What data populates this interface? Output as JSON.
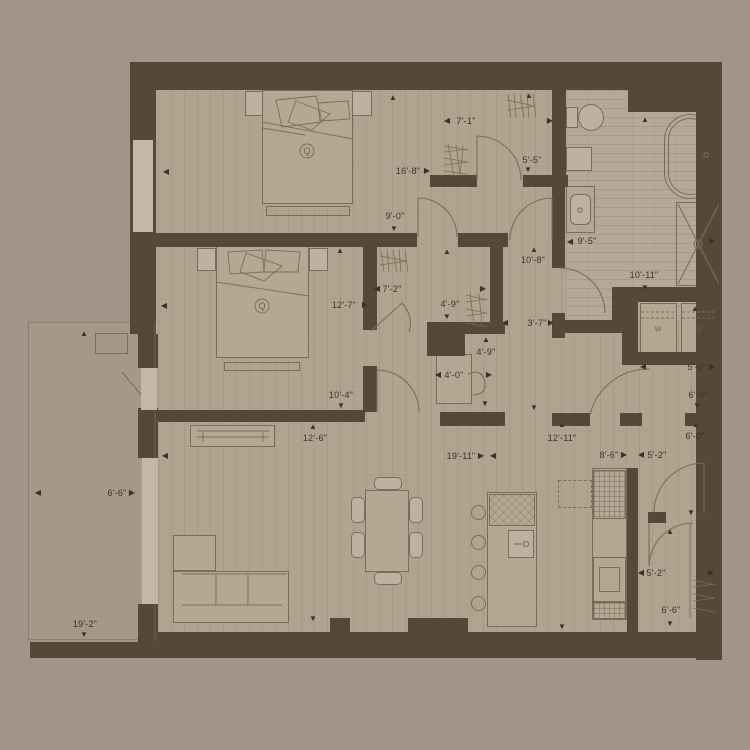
{
  "title": "apartment-floor-plan",
  "colors": {
    "background": "#a39489",
    "wall": "#564839",
    "wood_floor": "#b0a490",
    "tile_floor": "#b5a897",
    "outline": "#7b6c59",
    "text": "#3c3128",
    "balcony": "#a69888"
  },
  "beds": [
    {
      "label": "Q"
    },
    {
      "label": "Q"
    }
  ],
  "laundry": {
    "washer": "W",
    "dryer": "D"
  },
  "dimensions": [
    {
      "text": "7'-1\"",
      "x": 466,
      "y": 121,
      "arrows": [
        {
          "d": "left",
          "x": 447,
          "y": 121
        },
        {
          "d": "right",
          "x": 550,
          "y": 121
        }
      ]
    },
    {
      "text": "5'-5\"",
      "x": 532,
      "y": 160,
      "arrows": [
        {
          "d": "up",
          "x": 529,
          "y": 96
        },
        {
          "d": "down",
          "x": 528,
          "y": 170
        }
      ]
    },
    {
      "text": "16'-8\"",
      "x": 408,
      "y": 171,
      "arrows": [
        {
          "d": "left",
          "x": 166,
          "y": 172
        },
        {
          "d": "right",
          "x": 427,
          "y": 171
        }
      ]
    },
    {
      "text": "9'-0\"",
      "x": 395,
      "y": 216,
      "arrows": [
        {
          "d": "up",
          "x": 393,
          "y": 98
        },
        {
          "d": "down",
          "x": 394,
          "y": 229
        }
      ]
    },
    {
      "text": "9'-5\"",
      "x": 587,
      "y": 241,
      "arrows": [
        {
          "d": "left",
          "x": 570,
          "y": 242
        },
        {
          "d": "right",
          "x": 712,
          "y": 241
        }
      ]
    },
    {
      "text": "10'-11\"",
      "x": 644,
      "y": 275,
      "arrows": [
        {
          "d": "up",
          "x": 645,
          "y": 120
        },
        {
          "d": "down",
          "x": 645,
          "y": 288
        }
      ]
    },
    {
      "text": "10'-8\"",
      "x": 533,
      "y": 260,
      "arrows": [
        {
          "d": "up",
          "x": 534,
          "y": 250
        },
        {
          "d": "down",
          "x": 534,
          "y": 408
        }
      ]
    },
    {
      "text": "3'-7\"",
      "x": 537,
      "y": 323,
      "arrows": [
        {
          "d": "left",
          "x": 505,
          "y": 323
        },
        {
          "d": "right",
          "x": 551,
          "y": 323
        }
      ]
    },
    {
      "text": "12'-7\"",
      "x": 344,
      "y": 305,
      "arrows": [
        {
          "d": "left",
          "x": 164,
          "y": 306
        },
        {
          "d": "right",
          "x": 365,
          "y": 305
        }
      ]
    },
    {
      "text": "7'-2\"",
      "x": 392,
      "y": 289,
      "arrows": [
        {
          "d": "left",
          "x": 377,
          "y": 289
        },
        {
          "d": "right",
          "x": 483,
          "y": 289
        }
      ]
    },
    {
      "text": "4'-9\"",
      "x": 450,
      "y": 304,
      "arrows": [
        {
          "d": "up",
          "x": 447,
          "y": 252
        },
        {
          "d": "down",
          "x": 447,
          "y": 317
        }
      ]
    },
    {
      "text": "4'-9\"",
      "x": 486,
      "y": 352,
      "arrows": [
        {
          "d": "up",
          "x": 486,
          "y": 340
        },
        {
          "d": "down",
          "x": 485,
          "y": 404
        }
      ]
    },
    {
      "text": "4'-0\"",
      "x": 454,
      "y": 375,
      "arrows": [
        {
          "d": "left",
          "x": 438,
          "y": 375
        },
        {
          "d": "right",
          "x": 489,
          "y": 375
        }
      ]
    },
    {
      "text": "10'-4\"",
      "x": 341,
      "y": 395,
      "arrows": [
        {
          "d": "up",
          "x": 340,
          "y": 251
        },
        {
          "d": "down",
          "x": 341,
          "y": 406
        }
      ]
    },
    {
      "text": "12'-6\"",
      "x": 315,
      "y": 438,
      "arrows": [
        {
          "d": "up",
          "x": 313,
          "y": 427
        },
        {
          "d": "down",
          "x": 313,
          "y": 619
        }
      ]
    },
    {
      "text": "19'-11\"",
      "x": 461,
      "y": 456,
      "arrows": [
        {
          "d": "left",
          "x": 165,
          "y": 456
        },
        {
          "d": "right",
          "x": 481,
          "y": 456
        },
        {
          "d": "left",
          "x": 493,
          "y": 456
        }
      ]
    },
    {
      "text": "12'-11\"",
      "x": 562,
      "y": 438,
      "arrows": [
        {
          "d": "up",
          "x": 562,
          "y": 425
        },
        {
          "d": "down",
          "x": 562,
          "y": 627
        }
      ]
    },
    {
      "text": "8'-6\"",
      "x": 609,
      "y": 455,
      "arrows": [
        {
          "d": "right",
          "x": 624,
          "y": 455
        }
      ]
    },
    {
      "text": "5'-2\"",
      "x": 657,
      "y": 455,
      "arrows": [
        {
          "d": "left",
          "x": 641,
          "y": 455
        }
      ]
    },
    {
      "text": "6'-0\"",
      "x": 695,
      "y": 436,
      "arrows": [
        {
          "d": "up",
          "x": 696,
          "y": 425
        }
      ]
    },
    {
      "text": "5'-0\"",
      "x": 697,
      "y": 367,
      "arrows": [
        {
          "d": "left",
          "x": 643,
          "y": 367
        },
        {
          "d": "right",
          "x": 712,
          "y": 367
        }
      ]
    },
    {
      "text": "6'-9\"",
      "x": 698,
      "y": 395,
      "arrows": [
        {
          "d": "up",
          "x": 695,
          "y": 309
        },
        {
          "d": "down",
          "x": 697,
          "y": 406
        }
      ]
    },
    {
      "text": "5'-2\"",
      "x": 656,
      "y": 573,
      "arrows": [
        {
          "d": "left",
          "x": 641,
          "y": 573
        },
        {
          "d": "right",
          "x": 711,
          "y": 573
        }
      ]
    },
    {
      "text": "6'-6\"",
      "x": 671,
      "y": 610,
      "arrows": [
        {
          "d": "up",
          "x": 670,
          "y": 532
        },
        {
          "d": "down",
          "x": 670,
          "y": 624
        }
      ]
    },
    {
      "text": "6'-6\"",
      "x": 117,
      "y": 493,
      "arrows": [
        {
          "d": "left",
          "x": 38,
          "y": 493
        },
        {
          "d": "right",
          "x": 132,
          "y": 493
        }
      ]
    },
    {
      "text": "19'-2\"",
      "x": 85,
      "y": 624,
      "arrows": [
        {
          "d": "up",
          "x": 84,
          "y": 334
        },
        {
          "d": "down",
          "x": 84,
          "y": 635
        }
      ]
    }
  ],
  "extra_arrows": [
    {
      "d": "down",
      "x": 691,
      "y": 513
    }
  ]
}
